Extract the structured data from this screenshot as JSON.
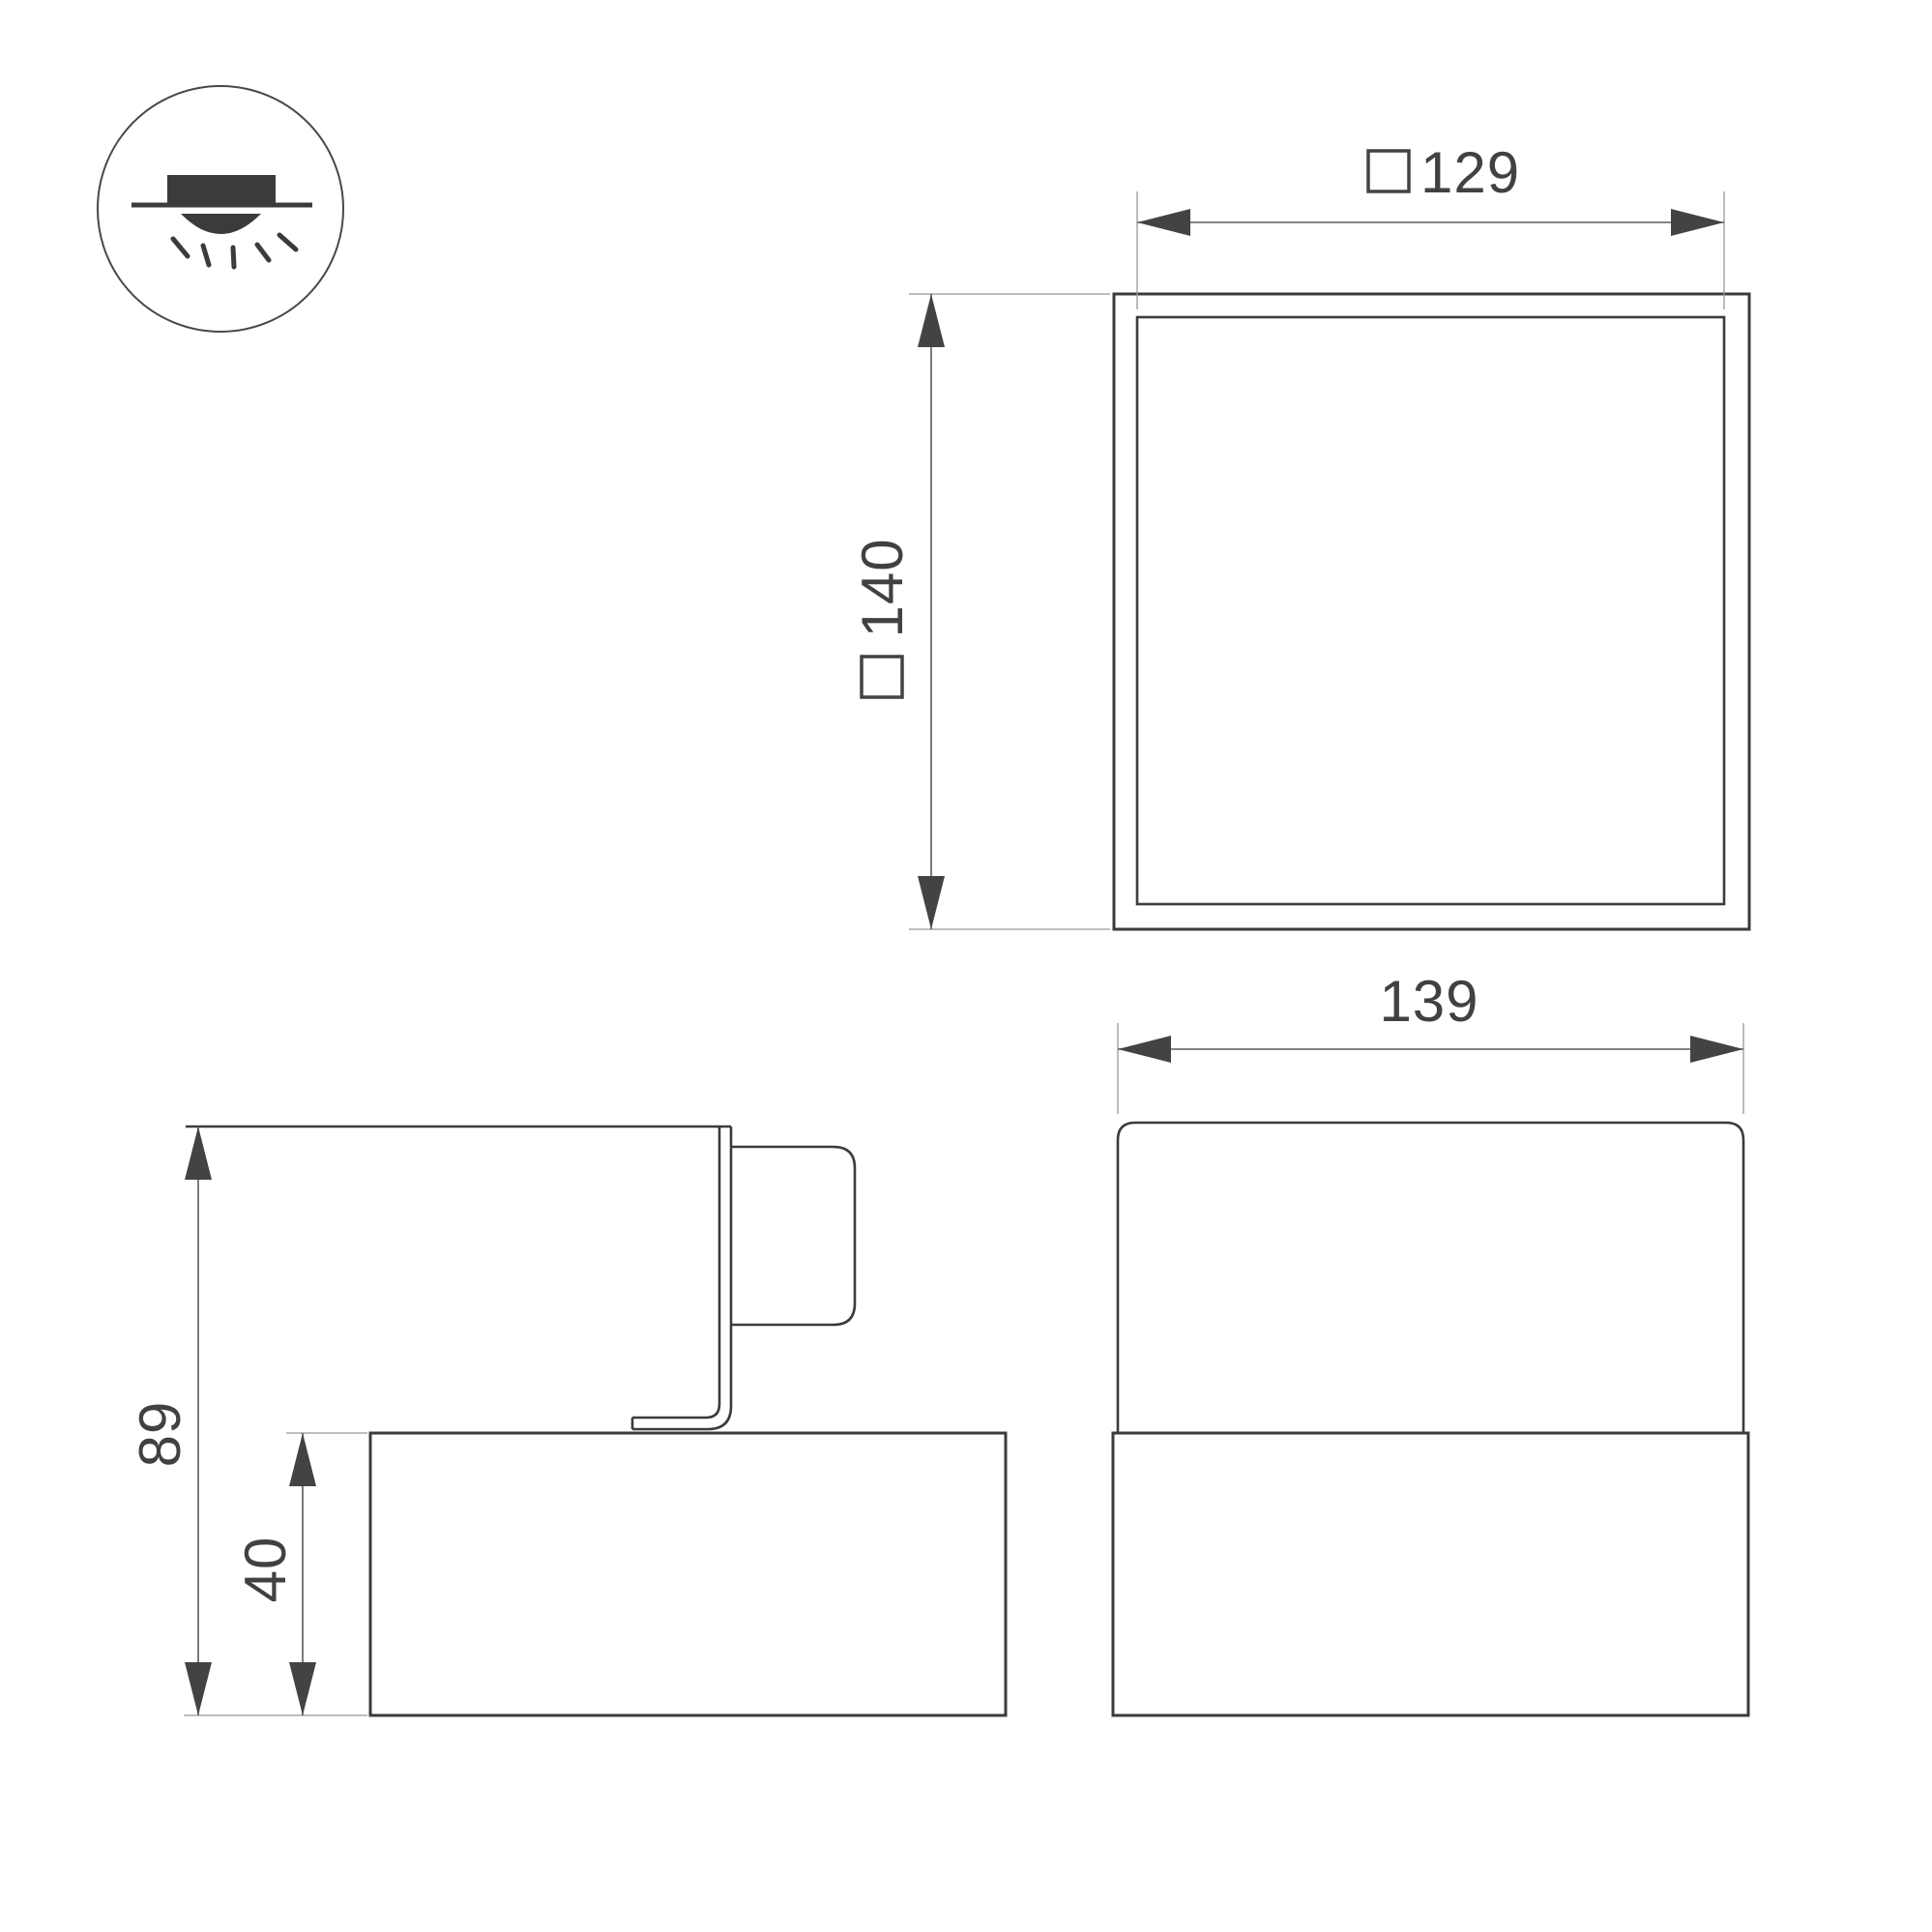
{
  "page": {
    "background": "#ffffff"
  },
  "drawing": {
    "mount_icon": {
      "name": "ceiling-surface-mount-icon",
      "elements": [
        "circle-outline",
        "ceiling-line",
        "fixture-body",
        "light-dome",
        "light-rays"
      ]
    },
    "top_view": {
      "panel_size": {
        "symbol": "□",
        "value": "129"
      },
      "overall_size": {
        "symbol": "□",
        "value": "140"
      }
    },
    "front_view": {
      "width": {
        "value": "139"
      }
    },
    "side_view": {
      "total_height": {
        "value": "89"
      },
      "base_height": {
        "value": "40"
      }
    },
    "colors": {
      "object_line": "#3b3b3d",
      "dimension_line": "#5b5b5d",
      "extension_line": "#97979b",
      "text": "#414143"
    }
  }
}
